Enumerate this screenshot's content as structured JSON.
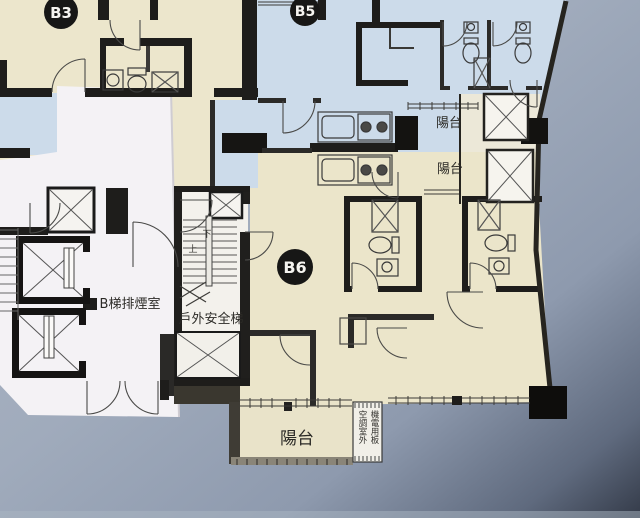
{
  "plan": {
    "units": {
      "b3": "B3",
      "b5": "B5",
      "b6": "B6"
    },
    "labels": {
      "smoke_room": "B梯排煙室",
      "outdoor_stair": "戶外安全梯",
      "balcony_b5": "陽台",
      "balcony_b6": "陽台",
      "balcony_south": "陽台",
      "equip_line1": "機電用板",
      "equip_line2": "空調室外",
      "up": "上",
      "down": "下"
    },
    "colors": {
      "paper_blue": "#a3aebf",
      "paper_dark_corner": "#3c4353",
      "unit_cream": "#ece6cc",
      "unit_blue": "#ccdbea",
      "overlay_white": "#f4f2f5",
      "wall_black": "#1e1d1b"
    }
  }
}
